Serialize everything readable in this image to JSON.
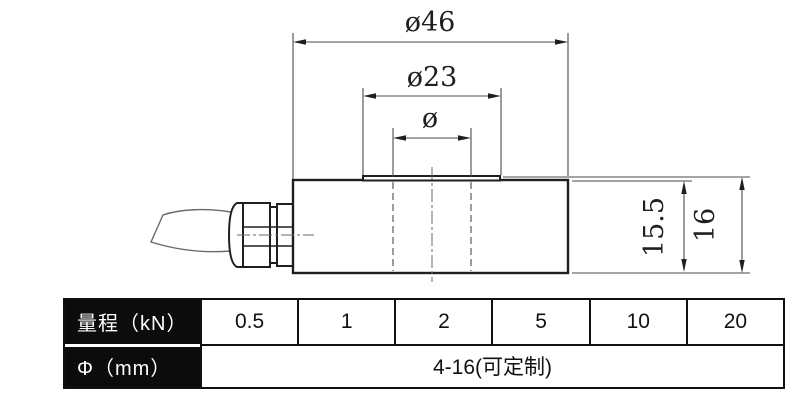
{
  "drawing": {
    "dimensions": {
      "outer_diameter": "ø46",
      "boss_diameter": "ø23",
      "hole_diameter": "ø",
      "body_height": "15.5",
      "total_height": "16"
    }
  },
  "spec_table": {
    "capacity_row": {
      "header": "量程（kN）",
      "values": [
        "0.5",
        "1",
        "2",
        "5",
        "10",
        "20"
      ]
    },
    "diameter_row": {
      "header": "Φ（mm）",
      "merged_value": "4-16(可定制)"
    }
  },
  "colors": {
    "outline": "#1f1f1f",
    "dim_line": "#4a4a4a",
    "table_header_bg": "#0c0c0c",
    "table_header_text": "#ffffff"
  }
}
